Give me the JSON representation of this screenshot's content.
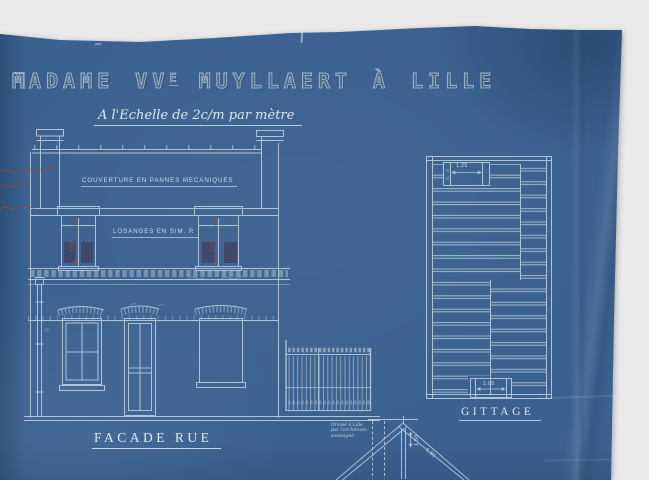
{
  "document": {
    "kind": "architectural blueprint (cyanotype)",
    "title": {
      "part1": "MADAME VV",
      "sup": "E",
      "part2": " MUYLLAERT À LILLE"
    },
    "scale_note": "A l'Echelle de 2c/m par mètre",
    "roof_note": "COUVERTURE EN PANNES MECANIQUES",
    "wall_note": "LOSANGES EN SIM. R",
    "labels": {
      "facade": "FACADE RUE",
      "joist_plan": "GITTAGE"
    },
    "architect_note": [
      "Dressé à Lille",
      "par l'architecte",
      "soussigné"
    ],
    "dimensions": {
      "upper_window_left": "1.50",
      "upper_window_right": "2.50",
      "gittage_top_chimney": "1.25",
      "gittage_bottom_chimney": "1.00",
      "truss_rise": "1.50",
      "truss_slope": "1.50"
    },
    "colors": {
      "paper_blue": "#3b6190",
      "drawing_line": "#c8d8e7",
      "bright_text": "#dde9f3",
      "red_ink": "#a34636",
      "background_white": "#eae8e9"
    }
  }
}
